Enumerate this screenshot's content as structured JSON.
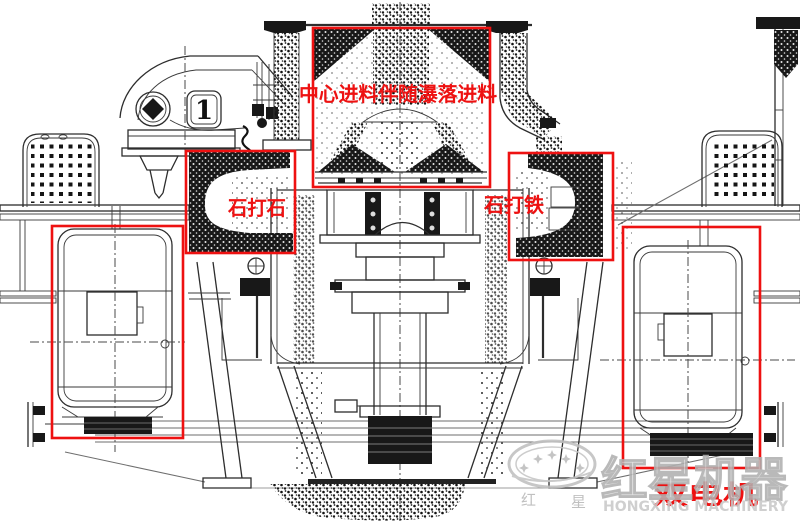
{
  "annotations": {
    "center_feed": "中心进料伴随瀑落进料",
    "stone_on_stone": "石打石",
    "stone_on_iron": "石打铁",
    "dual_motor": "双电机"
  },
  "drawing": {
    "part_label": "1"
  },
  "watermark": {
    "brand_cn": "红星机器",
    "brand_en": "HONGXING MACHINERY",
    "seal_char_left": "红",
    "seal_char_right": "星"
  },
  "colors": {
    "annotation_red": "#ee1111",
    "line_dark": "#2d2d2d",
    "watermark_gray": "#c3c3c3",
    "background": "#ffffff"
  }
}
